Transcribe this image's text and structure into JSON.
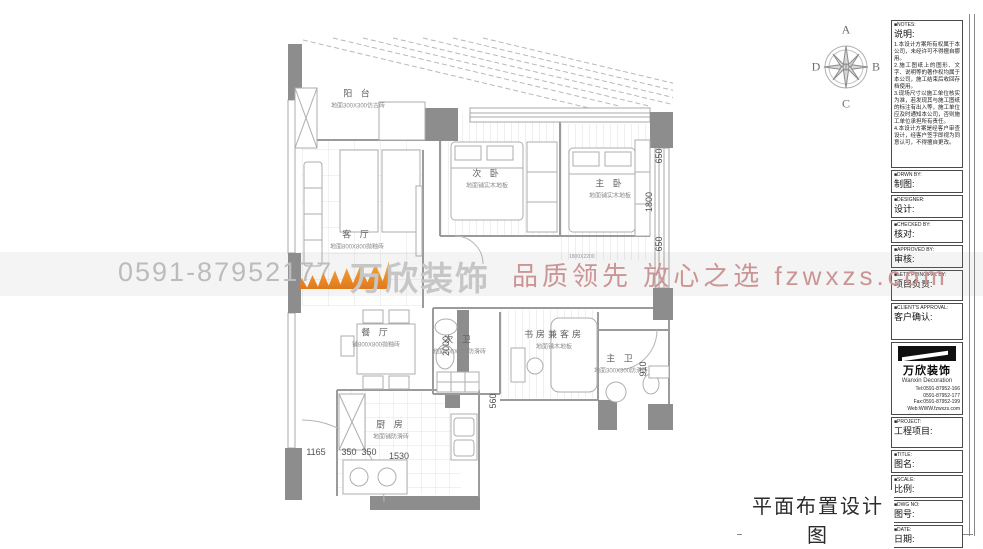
{
  "watermark": {
    "phone": "0591-87952177",
    "brand": "万欣装饰",
    "slogan": "品质领先 放心之选 fzwxzs.com"
  },
  "compass": {
    "n": "A",
    "e": "B",
    "s": "C",
    "w": "D"
  },
  "footer": {
    "drawing_title": "平面布置设计图"
  },
  "plan": {
    "rooms": [
      {
        "name": "阳 台",
        "finish": "地面300X300仿古砖"
      },
      {
        "name": "次 卧",
        "finish": "地面铺实木地板"
      },
      {
        "name": "主 卧",
        "finish": "地面铺实木地板"
      },
      {
        "name": "客 厅",
        "finish": "地面800X800抛釉砖"
      },
      {
        "name": "餐 厅",
        "finish": "铺800X800抛釉砖"
      },
      {
        "name": "次 卫",
        "finish": "地面300X300防滑砖"
      },
      {
        "name": "书房兼客房",
        "finish": "地面铺木地板"
      },
      {
        "name": "主 卫",
        "finish": "地面300X300防滑砖"
      },
      {
        "name": "厨 房",
        "finish": "地面铺防滑砖"
      }
    ],
    "bed_note": "1800X2200",
    "dims": {
      "right_top": "650",
      "right_mid": "1800",
      "right_bot": "650",
      "dining": "2000",
      "study": "560",
      "bath": "910",
      "b1": "1165",
      "b2": "350",
      "b3": "350",
      "b4": "1530"
    }
  },
  "title_block": {
    "notes_tag": "■NOTES:",
    "notes_label": "说明:",
    "notes_body": "1.本设计方案所有权属于本公司，未经许可不得擅自挪用。\n2.施工图纸上的图形、文字、说明等的著作权均属于本公司，施工结束后收回存档使用。\n3.现场尺寸以施工单位核实为准，若发现其与施工图纸的标注有出入等，施工单位应及时通知本公司，否则施工单位承担所有责任。\n4.本设计方案是经客户审查设计，经客户签字即视为同意认可，不得擅自更改。",
    "fields": [
      {
        "tag": "■DRWN BY:",
        "label": "制图:"
      },
      {
        "tag": "■DESIGNER:",
        "label": "设计:"
      },
      {
        "tag": "■CHECKED BY:",
        "label": "核对:"
      },
      {
        "tag": "■APPROVED BY:",
        "label": "审核:"
      },
      {
        "tag": "■LETR PRINCIPAL BY:",
        "label": "项目负责:"
      },
      {
        "tag": "■CLIENT'S APPROVAL:",
        "label": "客户确认:"
      }
    ],
    "company": {
      "logo_text": "万欣装饰",
      "logo_sub": "Wanxin Decoration",
      "tel1": "Tel:0591-87952-166",
      "tel2": "0591-87952-177",
      "fax": "Fax:0591-87952-199",
      "web": "Web:WWW.fzwxzs.com"
    },
    "fields2": [
      {
        "tag": "■PROJECT:",
        "label": "工程项目:"
      },
      {
        "tag": "■TITLE:",
        "label": "图名:"
      },
      {
        "tag": "■SCALE:",
        "label": "比例:"
      },
      {
        "tag": "■DWG NO:",
        "label": "图号:"
      },
      {
        "tag": "■DATE:",
        "label": "日期:"
      },
      {
        "tag": "■MODIFY:",
        "label": "修改:"
      }
    ]
  }
}
